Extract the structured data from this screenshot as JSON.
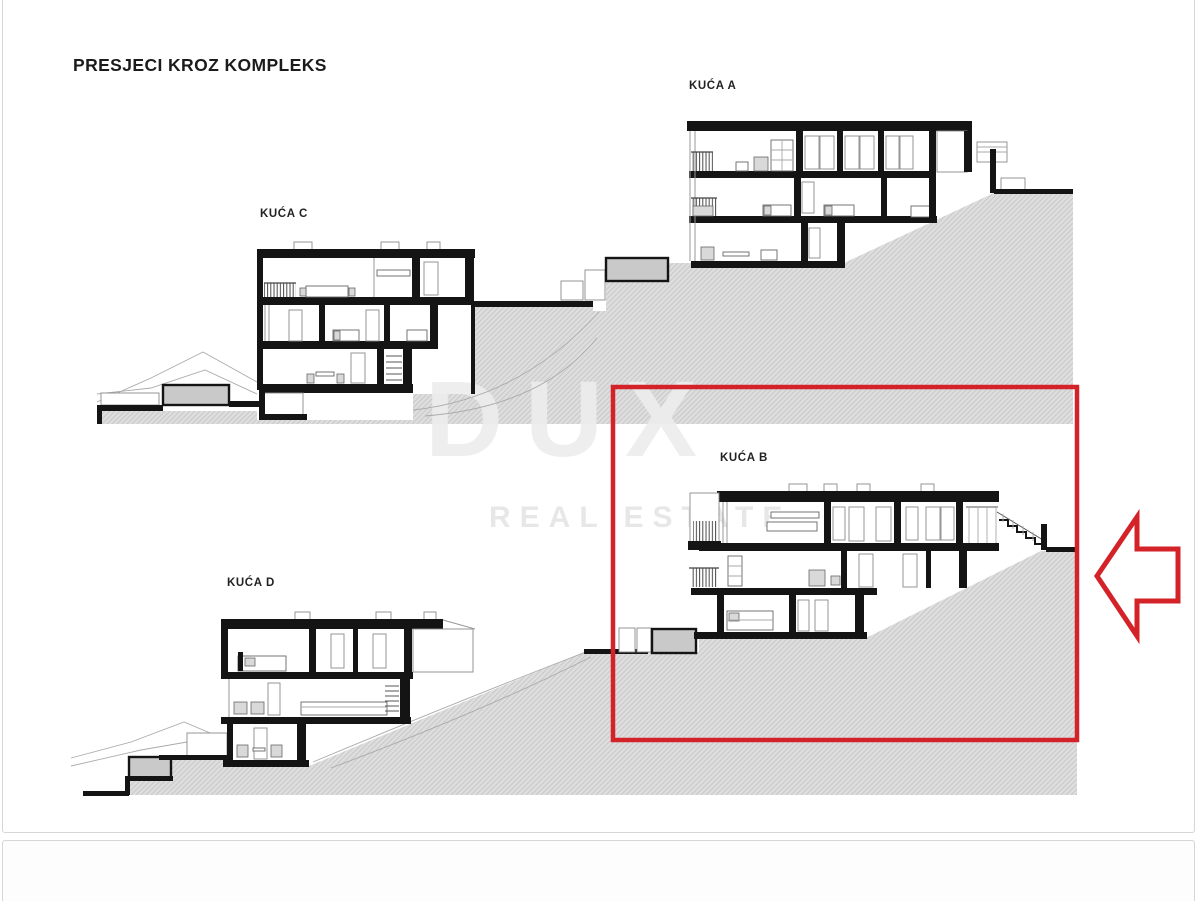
{
  "page": {
    "title": "PRESJECI KROZ KOMPLEKS"
  },
  "watermark": {
    "brand": "DUX",
    "tagline": "REAL ESTATE"
  },
  "houses": [
    {
      "id": "A",
      "label": "KUĆA A",
      "highlighted": false
    },
    {
      "id": "B",
      "label": "KUĆA B",
      "highlighted": true
    },
    {
      "id": "C",
      "label": "KUĆA C",
      "highlighted": false
    },
    {
      "id": "D",
      "label": "KUĆA D",
      "highlighted": false
    }
  ],
  "annotations": {
    "highlight_box_target": "KUĆA B",
    "arrow_direction": "left",
    "accent_color": "#d42229"
  },
  "colors": {
    "ink": "#141414",
    "terrain_fill": "#dedede",
    "terrain_hatch_line": "#c9c9c9",
    "watermark_gray": "#ececec"
  }
}
